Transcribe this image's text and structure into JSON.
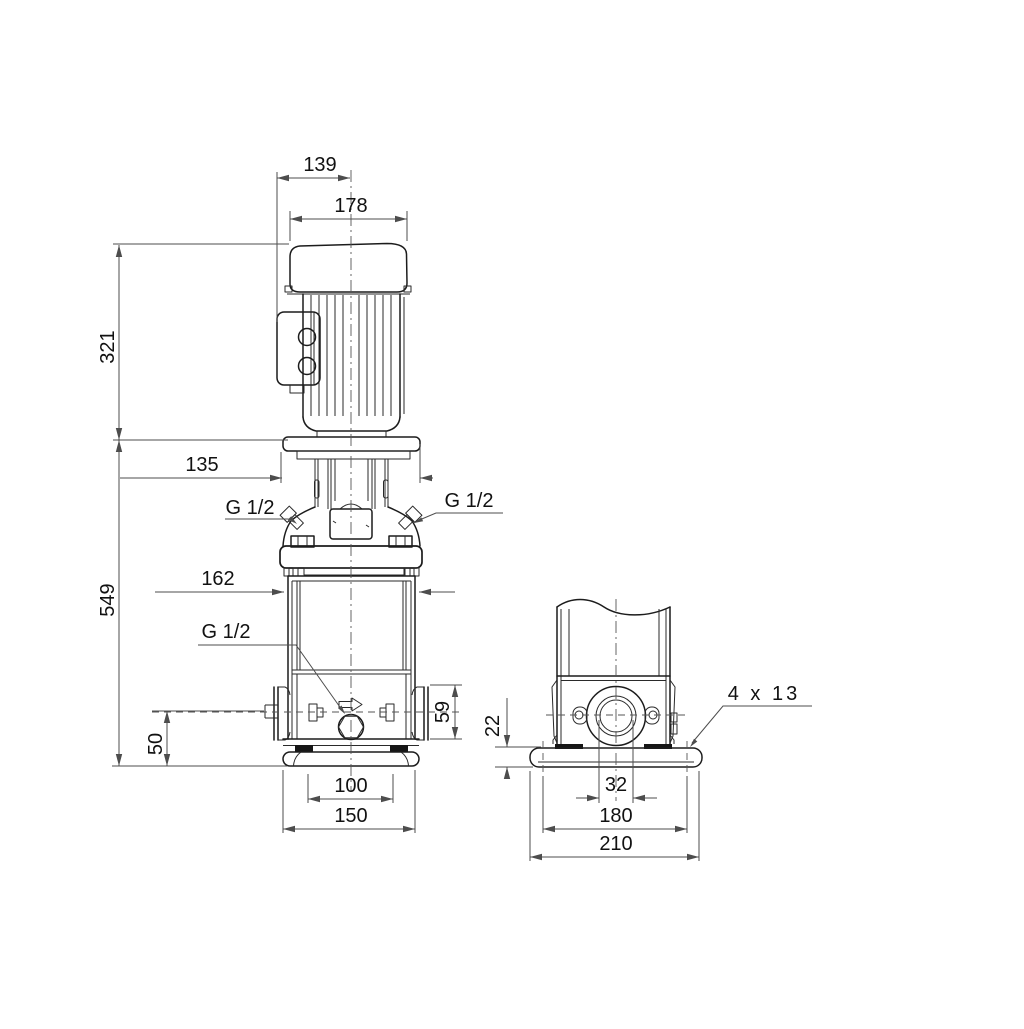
{
  "drawing": {
    "title": "vertical-multistage-pump-dimensional-drawing",
    "colors": {
      "outline": "#1c1c1c",
      "dimension": "#4d4d4d",
      "background": "#ffffff"
    },
    "dims": {
      "front": {
        "box_to_center": "139",
        "motor_width": "178",
        "motor_height": "321",
        "head_width": "135",
        "total_height": "549",
        "chamber_width": "162",
        "port_center_height": "50",
        "flange_height": "59",
        "foot_holes": "100",
        "foot_width": "150"
      },
      "plugs": {
        "left": "G 1/2",
        "right": "G 1/2",
        "drain": "G 1/2"
      },
      "side": {
        "base_thickness": "22",
        "port_bore": "32",
        "hole_spacing": "180",
        "base_width": "210",
        "holes": "4 x 13"
      }
    }
  }
}
